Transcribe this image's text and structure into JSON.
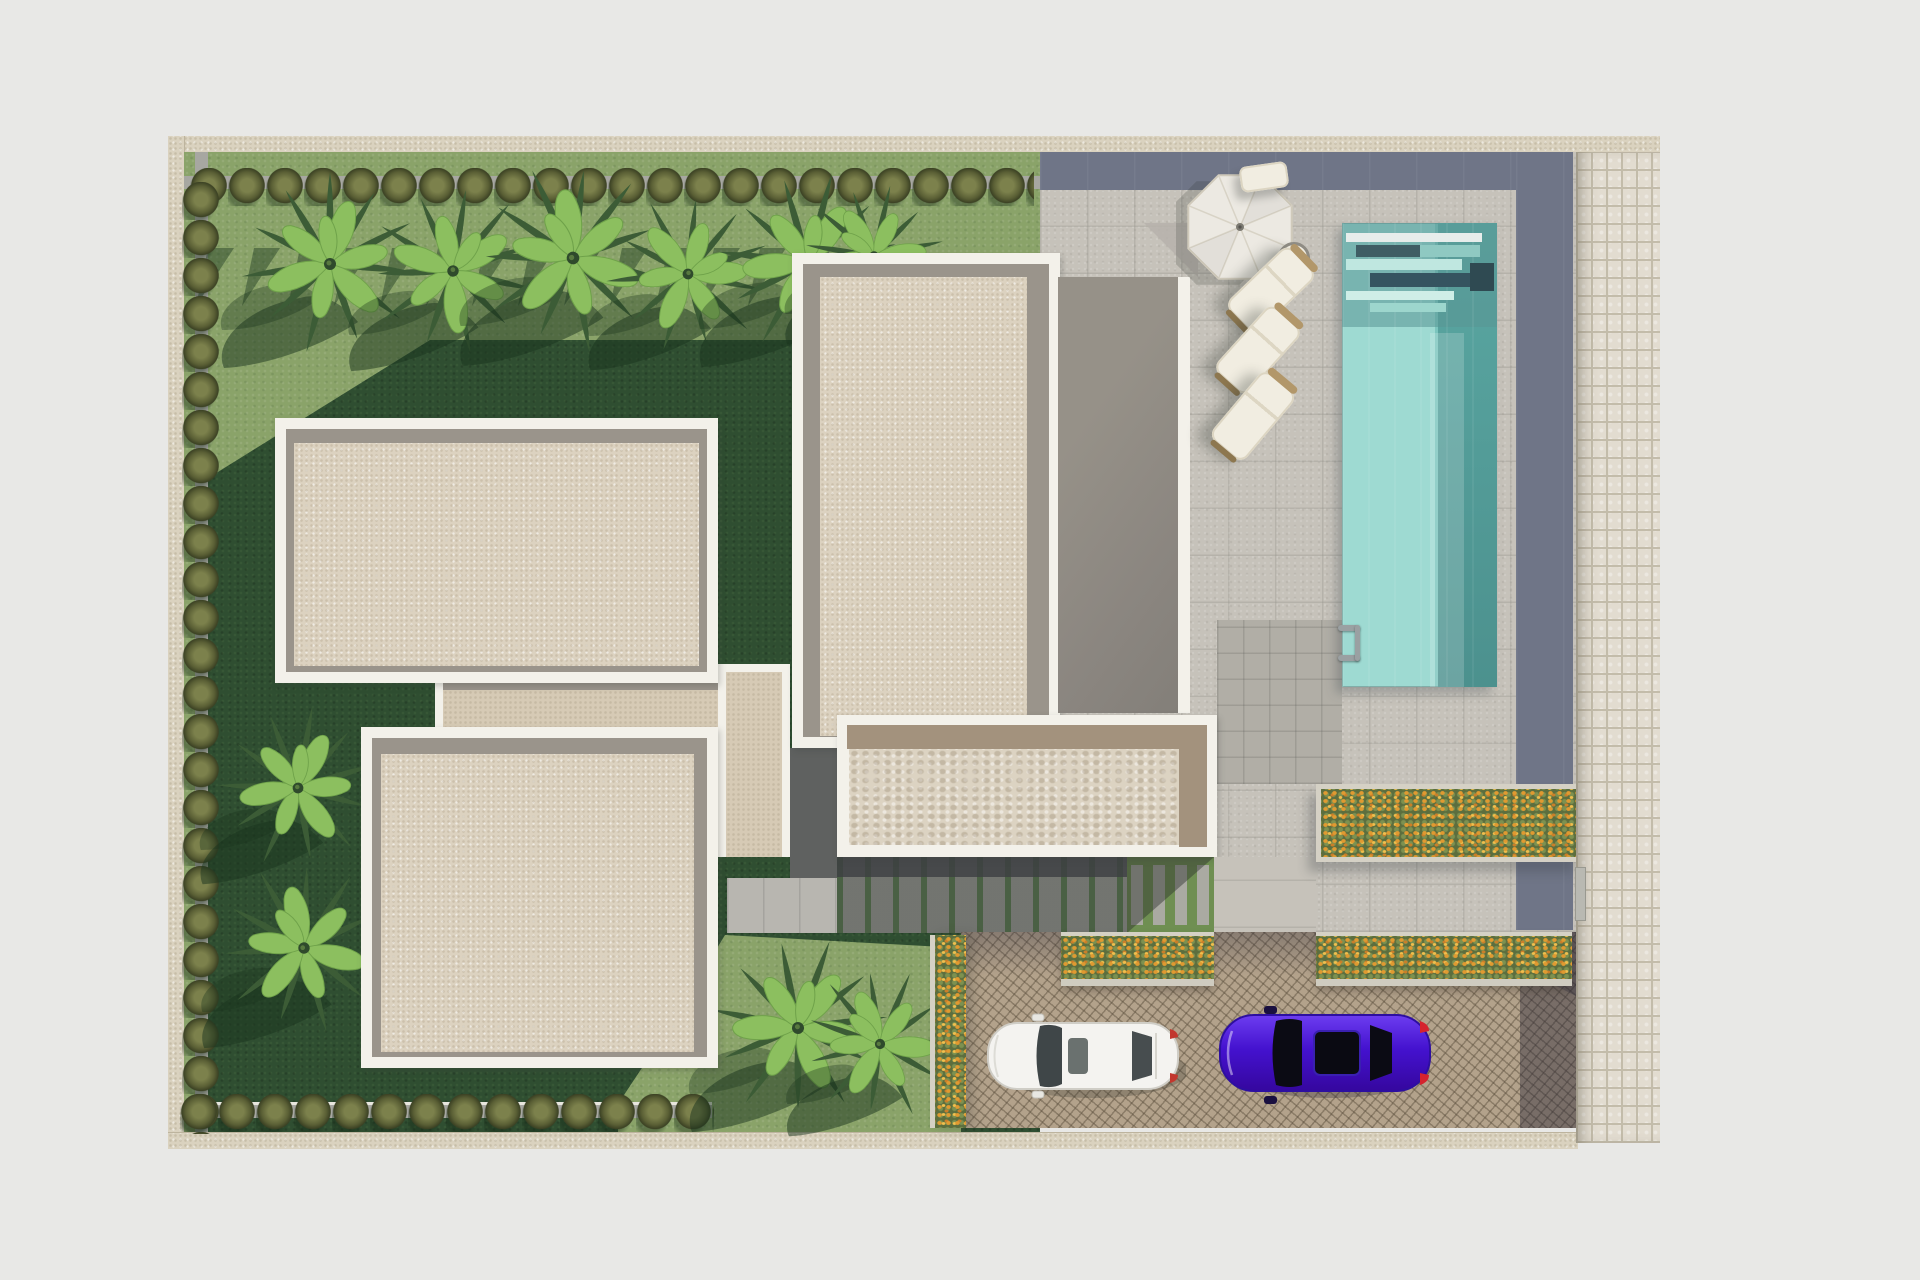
{
  "scene": {
    "type": "architectural-site-plan-3d-render",
    "view": "top-down aerial",
    "garden": {
      "label": "lawn garden with palm trees",
      "palm_tree_count": 10,
      "hedge_rows": [
        "top",
        "left",
        "bottom"
      ]
    },
    "buildings": {
      "count": 4,
      "roof_style": "flat beige roofs with white parapet rims and gray inner bands",
      "extras": [
        "gray garage roof",
        "connector roofs",
        "concrete pad"
      ]
    },
    "pool_area": {
      "pool": "rectangular turquoise pool with entry steps and ladder",
      "parasol_count": 1,
      "sun_lounger_count": 3,
      "side_table_count": 1
    },
    "planters": {
      "count": 4,
      "flowers": "orange and yellow blossoms in green beds"
    },
    "driveway": {
      "surface": "tan cobblestone",
      "cars": [
        {
          "label": "white-car",
          "color": "#f4f3f0"
        },
        {
          "label": "purple-car",
          "color": "#4412cf"
        }
      ]
    },
    "paths": {
      "right_edge": "light paver strip",
      "walkways": "gray tile terrace and striped paver walk"
    }
  },
  "colors": {
    "bg": "#e8e8e6",
    "wall": "#dad2bf",
    "wallline": "#bdb49e",
    "path": "#a7a7a1",
    "lawn1": "#8aa369",
    "lawn2": "#2f4e31",
    "bush1": "#7c814c",
    "bush2": "#5a5f35",
    "palm1": "#3c5c36",
    "palm2": "#8cbf5f",
    "palm3": "#6fa24a",
    "shadowg": "rgba(25,52,30,0.50)",
    "rim": "#f3f1ea",
    "band": "#9a948b",
    "roof": "#dcd2c0",
    "roofc": "#d6cab5",
    "roofd": "#dcd3c2",
    "dband": "#6f7587",
    "dstrip": "#5f6160",
    "garage": "#8b8680",
    "patio": "#c6c2ba",
    "patiodark": "#b1aea6",
    "concrete": "#b8b6b0",
    "zebragreen": "#4f6b44",
    "zebragray": "#858780",
    "patchgreen": "#6f8f52",
    "pool1": "#9edad2",
    "pool2": "#63b3ad",
    "pools1": "#e7edeb",
    "pools2": "#3f5d64",
    "pools3": "#bfe7e0",
    "cobble": "#e2dcd0",
    "cobblej": "#c3bcaa",
    "drive": "#b3a28b",
    "flower1": "#e09a31",
    "flower2": "#f0bf4e",
    "flower3": "#7d9150",
    "leafbed": "#5c6e3e",
    "curb": "#d5d1c5",
    "umb": "#ece9e2",
    "umbline": "#d0cabb",
    "lounger": "#f1ede1",
    "wood": "#b2976a",
    "carwhite": "#f4f3f0",
    "carpurple": "#4412cf",
    "glass": "#0b0b14",
    "tail": "#d5232e"
  }
}
